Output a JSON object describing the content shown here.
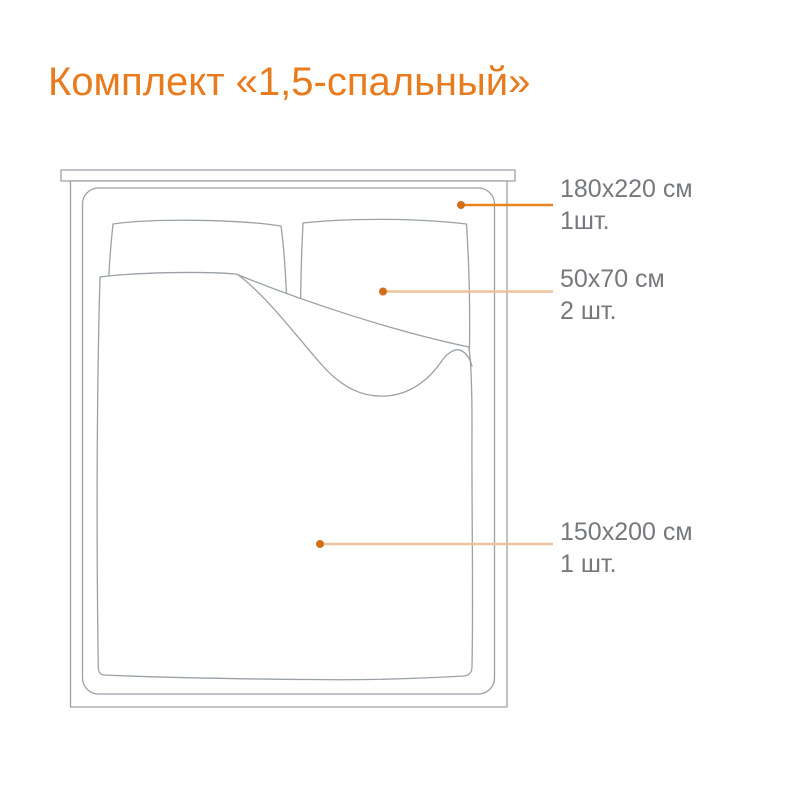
{
  "title": "Комплект «1,5-спальный»",
  "labels": [
    {
      "size": "180x220 см",
      "qty": "1шт."
    },
    {
      "size": "50x70 см",
      "qty": "2 шт."
    },
    {
      "size": "150x200 см",
      "qty": "1 шт."
    }
  ],
  "colors": {
    "title": "#e87b1e",
    "label_text": "#75797d",
    "leader_strong": "#e8831f",
    "leader_light": "#eec29a",
    "leader_dot": "#d16f1b",
    "drawing": "#9aa1a7"
  }
}
